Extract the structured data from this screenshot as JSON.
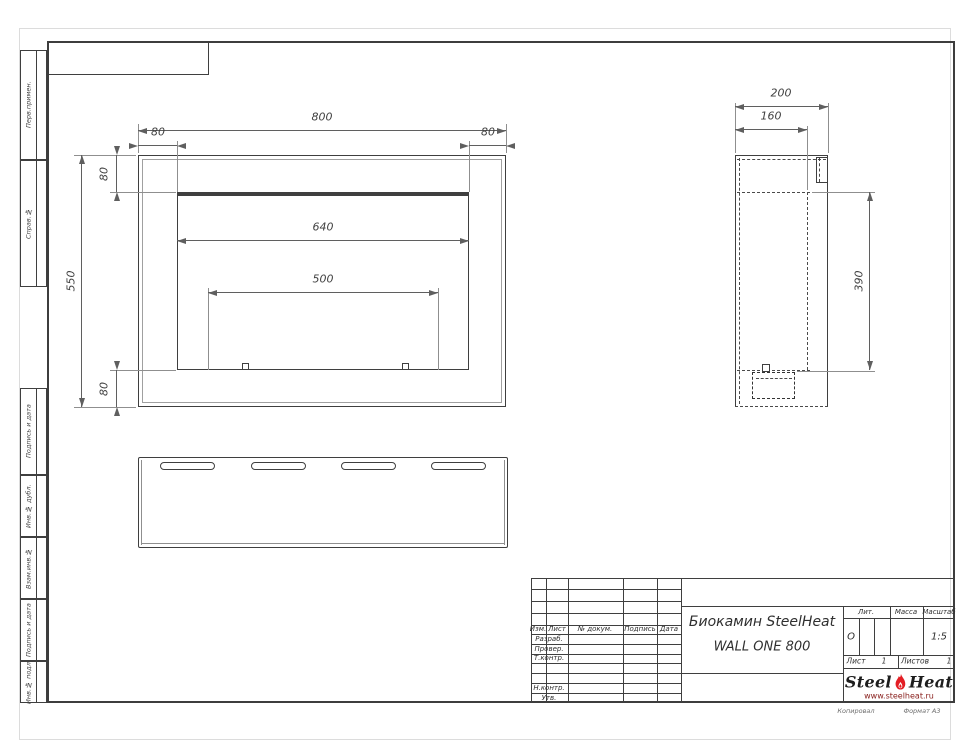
{
  "drawing": {
    "front_view": {
      "dims": {
        "overall_width": "800",
        "margin_left": "80",
        "margin_right": "80",
        "margin_top": "80",
        "overall_height": "550",
        "margin_bottom": "80",
        "opening_width": "640",
        "slot_span": "500"
      }
    },
    "side_view": {
      "dims": {
        "depth": "200",
        "inner_depth": "160",
        "opening_height": "390"
      }
    }
  },
  "side_strip": {
    "items": [
      {
        "label": "Перв.примен."
      },
      {
        "label": "Справ.№"
      },
      {
        "label": "Подпись и дата"
      },
      {
        "label": "Инв.№ дубл."
      },
      {
        "label": "Взам.инв.№"
      },
      {
        "label": "Подпись и дата"
      },
      {
        "label": "Инв.№ подл."
      }
    ]
  },
  "title_block": {
    "revision_header": {
      "izm": "Изм.",
      "list": "Лист",
      "doc": "№ докум.",
      "sign": "Подпись",
      "date": "Дата"
    },
    "role_rows": [
      "Разраб.",
      "Провер.",
      "Т.контр.",
      "Н.контр.",
      "Утв."
    ],
    "doc_title_line1": "Биокамин SteelHeat",
    "doc_title_line2": "WALL ONE 800",
    "lit_label": "Лит.",
    "lit_value": "О",
    "mass_label": "Масса",
    "scale_label": "Масштаб",
    "scale_value": "1:5",
    "sheet_label": "Лист",
    "sheet_number": "1",
    "sheets_label": "Листов",
    "sheets_total": "1",
    "logo": {
      "word1": "Steel",
      "word2": "Heat",
      "website": "www.steelheat.ru"
    }
  },
  "footer": {
    "copy_label": "Копировал",
    "format_label": "Формат А3"
  },
  "colors": {
    "line": "#3f3f3f",
    "dim_line": "#5f5f5f",
    "logo_red": "#e31e24",
    "logo_url": "#8b2320"
  }
}
